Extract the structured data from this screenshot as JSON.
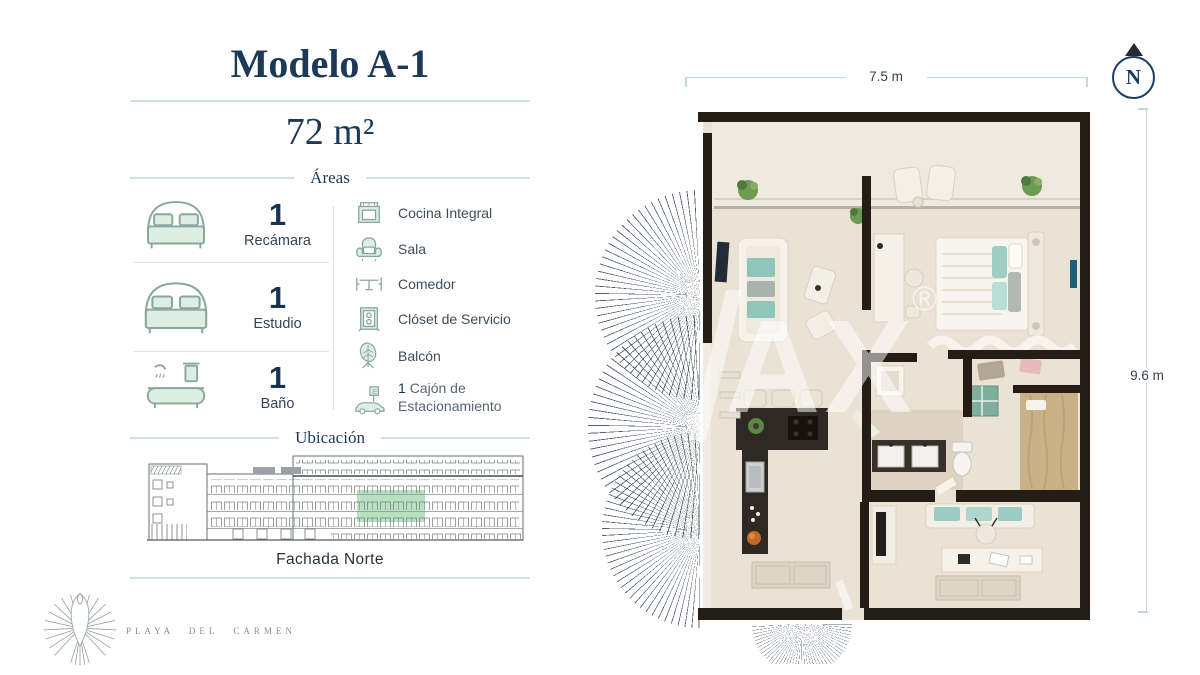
{
  "left_panel": {
    "title": "Modelo A-1",
    "area": "72 m²",
    "areas_heading": "Áreas",
    "stats": [
      {
        "count": "1",
        "label": "Recámara",
        "icon": "double-bed"
      },
      {
        "count": "1",
        "label": "Estudio",
        "icon": "double-bed"
      },
      {
        "count": "1",
        "label": "Baño",
        "icon": "bathtub"
      }
    ],
    "amenities": [
      {
        "label": "Cocina Integral",
        "icon": "stove"
      },
      {
        "label": "Sala",
        "icon": "armchair"
      },
      {
        "label": "Comedor",
        "icon": "dining-table"
      },
      {
        "label": "Clóset de Servicio",
        "icon": "closet"
      },
      {
        "label": "Balcón",
        "icon": "plant-leaf"
      }
    ],
    "parking": {
      "count": "1",
      "line1": "Cajón de",
      "line2": "Estacionamiento",
      "sign": "E",
      "icon": "car"
    },
    "location": {
      "heading": "Ubicación",
      "caption": "Fachada Norte"
    }
  },
  "brand": {
    "name": "PLAYA DEL CARMEN"
  },
  "floorplan": {
    "width_label": "7.5 m",
    "height_label": "9.6 m",
    "north_label": "N",
    "watermark": "AX",
    "watermark_reg": "®"
  },
  "colors": {
    "navy": "#1c3a58",
    "divider_mint": "#cfe5dc",
    "icon_mint": "#ddeee3",
    "icon_stroke": "#8aa79e",
    "highlight_green": "#b7e1c1",
    "wall_dark": "#241d16",
    "floor_cream": "#eae2d4",
    "teal_accent": "#8fc5bb"
  }
}
